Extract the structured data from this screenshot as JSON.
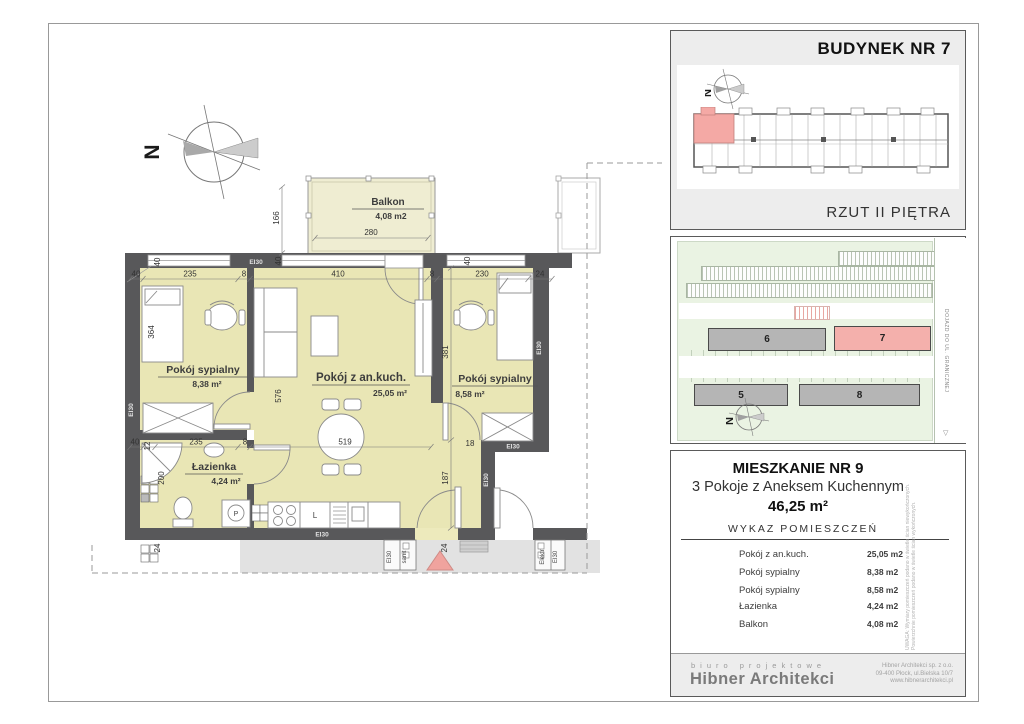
{
  "plan": {
    "north": "N",
    "labels": {
      "ei30": "EI30",
      "sanit": "sanit",
      "elektr": "Elektr",
      "washer": "P",
      "sink": "L"
    },
    "rooms": {
      "living": {
        "name": "Pokój z an.kuch.",
        "area": "25,05 m²"
      },
      "bedroom_left": {
        "name": "Pokój sypialny",
        "area": "8,38 m²"
      },
      "bedroom_right": {
        "name": "Pokój sypialny",
        "area": "8,58 m²"
      },
      "bathroom": {
        "name": "Łazienka",
        "area": "4,24 m²"
      },
      "balcony": {
        "name": "Balkon",
        "area": "4,08 m2"
      }
    },
    "dims": {
      "d40": "40",
      "d235": "235",
      "d8": "8",
      "d410": "410",
      "d230": "230",
      "d24": "24",
      "d280": "280",
      "d166": "166",
      "d364": "364",
      "d576": "576",
      "d519": "519",
      "d381": "381",
      "d200": "200",
      "d12": "12",
      "d187": "187",
      "d18": "18"
    }
  },
  "building_panel": {
    "title": "BUDYNEK NR 7",
    "caption": "RZUT II PIĘTRA",
    "north": "N"
  },
  "site_panel": {
    "b5": "5",
    "b6": "6",
    "b7": "7",
    "b8": "8",
    "road_label": "DOJAZD DO UL. GRANICZNEJ",
    "north": "N"
  },
  "apartment_panel": {
    "title": "MIESZKANIE NR 9",
    "subtitle": "3 Pokoje z Aneksem Kuchennym",
    "total_area": "46,25 m²",
    "list_title": "WYKAZ POMIESZCZEŃ",
    "rooms": [
      {
        "name": "Pokój z an.kuch.",
        "area": "25,05 m2"
      },
      {
        "name": "Pokój sypialny",
        "area": "8,38 m2"
      },
      {
        "name": "Pokój sypialny",
        "area": "8,58 m2"
      },
      {
        "name": "Łazienka",
        "area": "4,24 m2"
      },
      {
        "name": "Balkon",
        "area": "4,08 m2"
      }
    ],
    "disclaimer": "UWAGA: Wymiary pomieszczeń podano w świetle ścian niewykończonych. Powierzchnie pomieszczeń podano w świetle ścian wykończonych."
  },
  "footer": {
    "studio_type": "biuro projektowe",
    "studio_name": "Hibner Architekci",
    "address_lines": [
      "Hibner Architekci sp. z o.o.",
      "09-400 Płock, ul.Bielska 10/7",
      "www.hibnerarchitekci.pl"
    ]
  },
  "colors": {
    "wall": "#58585a",
    "room_fill": "#e9e6b5",
    "balcony_fill": "#efedd2",
    "corridor": "#e2e2e2",
    "highlight_pink": "#f4b0ac",
    "site_green": "#eaf3e3",
    "building_gray": "#b5b5b5",
    "entry_triangle": "#f0a39e"
  }
}
